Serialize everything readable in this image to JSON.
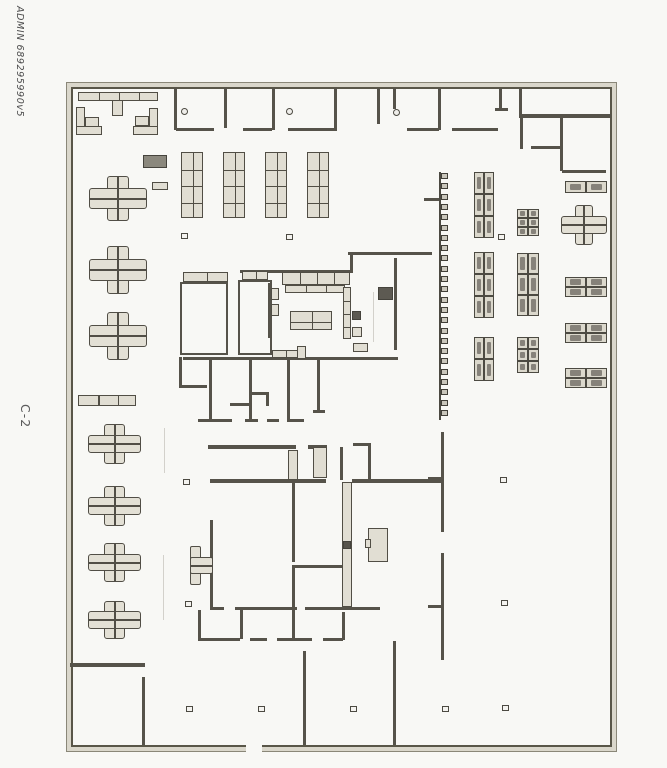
{
  "annotations": {
    "doc_id": "ADMIN 689295990v5",
    "sheet_label": "C-2"
  },
  "colors": {
    "paper": "#f8f8f5",
    "ink": "#56534a",
    "furniture_fill": "#e1ded3",
    "dark_fill": "#5d5a52",
    "gray_fill": "#8b887d"
  },
  "plan": {
    "frame": {
      "x": 66,
      "y": 82,
      "w": 551,
      "h": 670
    },
    "walls": [
      [
        174,
        88,
        3,
        42
      ],
      [
        224,
        88,
        3,
        40
      ],
      [
        272,
        88,
        3,
        42
      ],
      [
        334,
        88,
        3,
        43
      ],
      [
        377,
        88,
        3,
        36
      ],
      [
        393,
        88,
        3,
        21
      ],
      [
        438,
        88,
        3,
        42
      ],
      [
        499,
        88,
        3,
        21
      ],
      [
        176,
        128,
        38,
        3
      ],
      [
        243,
        128,
        29,
        3
      ],
      [
        288,
        128,
        48,
        3
      ],
      [
        407,
        128,
        32,
        3
      ],
      [
        452,
        128,
        46,
        3
      ],
      [
        495,
        108,
        13,
        3
      ],
      [
        519,
        88,
        3,
        28
      ],
      [
        519,
        114,
        92,
        4
      ],
      [
        520,
        118,
        3,
        31
      ],
      [
        531,
        146,
        31,
        3
      ],
      [
        560,
        117,
        3,
        54
      ],
      [
        562,
        170,
        44,
        3
      ],
      [
        240,
        270,
        112,
        3
      ],
      [
        348,
        252,
        84,
        3
      ],
      [
        350,
        252,
        3,
        21
      ],
      [
        394,
        258,
        3,
        92
      ],
      [
        268,
        283,
        3,
        55
      ],
      [
        180,
        282,
        2,
        73
      ],
      [
        226,
        282,
        2,
        73
      ],
      [
        180,
        282,
        48,
        2
      ],
      [
        180,
        353,
        48,
        2
      ],
      [
        238,
        280,
        2,
        75
      ],
      [
        238,
        280,
        34,
        2
      ],
      [
        238,
        353,
        34,
        2
      ],
      [
        270,
        280,
        2,
        75
      ],
      [
        183,
        357,
        215,
        3
      ],
      [
        179,
        357,
        3,
        31
      ],
      [
        179,
        385,
        28,
        3
      ],
      [
        209,
        360,
        3,
        62
      ],
      [
        249,
        360,
        3,
        62
      ],
      [
        287,
        360,
        3,
        62
      ],
      [
        317,
        360,
        3,
        53
      ],
      [
        313,
        410,
        12,
        3
      ],
      [
        230,
        403,
        22,
        3
      ],
      [
        252,
        392,
        17,
        3
      ],
      [
        266,
        392,
        3,
        14
      ],
      [
        198,
        419,
        34,
        3
      ],
      [
        245,
        419,
        13,
        3
      ],
      [
        267,
        419,
        12,
        3
      ],
      [
        290,
        419,
        14,
        3
      ],
      [
        424,
        198,
        17,
        3
      ],
      [
        208,
        445,
        88,
        4
      ],
      [
        308,
        445,
        19,
        4
      ],
      [
        340,
        447,
        3,
        33
      ],
      [
        353,
        443,
        17,
        3
      ],
      [
        368,
        443,
        3,
        38
      ],
      [
        210,
        479,
        116,
        4
      ],
      [
        352,
        479,
        90,
        4
      ],
      [
        210,
        520,
        3,
        88
      ],
      [
        292,
        482,
        3,
        80
      ],
      [
        292,
        565,
        50,
        3
      ],
      [
        292,
        568,
        3,
        40
      ],
      [
        441,
        432,
        3,
        100
      ],
      [
        441,
        553,
        3,
        107
      ],
      [
        428,
        477,
        14,
        3
      ],
      [
        428,
        605,
        14,
        3
      ],
      [
        210,
        607,
        14,
        3
      ],
      [
        235,
        607,
        62,
        3
      ],
      [
        305,
        607,
        75,
        3
      ],
      [
        198,
        610,
        3,
        29
      ],
      [
        240,
        610,
        3,
        29
      ],
      [
        292,
        610,
        3,
        30
      ],
      [
        342,
        612,
        3,
        28
      ],
      [
        198,
        638,
        42,
        3
      ],
      [
        250,
        638,
        17,
        3
      ],
      [
        277,
        638,
        35,
        3
      ],
      [
        323,
        638,
        20,
        3
      ],
      [
        70,
        663,
        75,
        4
      ],
      [
        142,
        677,
        3,
        68
      ],
      [
        303,
        651,
        3,
        94
      ],
      [
        393,
        641,
        3,
        104
      ]
    ],
    "light_blocks": [
      [
        112,
        97,
        11,
        19
      ],
      [
        76,
        107,
        9,
        27
      ],
      [
        76,
        126,
        26,
        9
      ],
      [
        85,
        117,
        14,
        10
      ],
      [
        149,
        108,
        9,
        27
      ],
      [
        133,
        126,
        25,
        9
      ],
      [
        135,
        116,
        14,
        10
      ],
      [
        288,
        450,
        10,
        30
      ],
      [
        313,
        447,
        14,
        31
      ],
      [
        342,
        482,
        10,
        125
      ],
      [
        368,
        528,
        20,
        34
      ],
      [
        365,
        539,
        6,
        9
      ],
      [
        352,
        327,
        10,
        10
      ],
      [
        353,
        343,
        15,
        9
      ],
      [
        297,
        346,
        9,
        13
      ],
      [
        271,
        288,
        8,
        12
      ],
      [
        271,
        304,
        8,
        12
      ],
      [
        152,
        182,
        16,
        8
      ]
    ],
    "dark_blocks": [
      [
        143,
        155,
        24,
        13,
        "#8b887d"
      ],
      [
        378,
        287,
        15,
        13,
        "#5d5a52"
      ],
      [
        352,
        311,
        9,
        9,
        "#5d5a52"
      ],
      [
        343,
        541,
        8,
        8,
        "#57544c"
      ]
    ],
    "grid_tables": [
      [
        78,
        92,
        80,
        9,
        4,
        1
      ],
      [
        181,
        152,
        22,
        66,
        2,
        4
      ],
      [
        223,
        152,
        22,
        66,
        2,
        4
      ],
      [
        265,
        152,
        22,
        66,
        2,
        4
      ],
      [
        307,
        152,
        22,
        66,
        2,
        4
      ],
      [
        282,
        272,
        68,
        13,
        4,
        1
      ],
      [
        285,
        285,
        60,
        8,
        3,
        1
      ],
      [
        290,
        311,
        42,
        19,
        2,
        2
      ],
      [
        343,
        287,
        8,
        52,
        1,
        4
      ],
      [
        272,
        350,
        26,
        8,
        2,
        1
      ],
      [
        183,
        272,
        45,
        10,
        2,
        1
      ],
      [
        242,
        271,
        26,
        9,
        2,
        1
      ],
      [
        78,
        395,
        58,
        11,
        3,
        1
      ]
    ],
    "desk_groups": [
      [
        474,
        172,
        2,
        3,
        10,
        22
      ],
      [
        474,
        252,
        2,
        3,
        10,
        22
      ],
      [
        474,
        337,
        2,
        2,
        10,
        22
      ],
      [
        517,
        209,
        2,
        3,
        11,
        9
      ],
      [
        517,
        253,
        2,
        3,
        11,
        21
      ],
      [
        517,
        337,
        2,
        3,
        11,
        12
      ],
      [
        565,
        181,
        2,
        1,
        21,
        12
      ],
      [
        565,
        277,
        2,
        2,
        21,
        10
      ],
      [
        565,
        323,
        2,
        2,
        21,
        10
      ],
      [
        565,
        368,
        2,
        2,
        21,
        10
      ]
    ],
    "crosses": [
      [
        89,
        176,
        58,
        45
      ],
      [
        89,
        246,
        58,
        48
      ],
      [
        89,
        312,
        58,
        48
      ],
      [
        88,
        424,
        53,
        40
      ],
      [
        88,
        486,
        53,
        40
      ],
      [
        88,
        543,
        53,
        39
      ],
      [
        88,
        601,
        53,
        38
      ],
      [
        561,
        205,
        46,
        40
      ]
    ],
    "half_cross": [
      190,
      543,
      23,
      45
    ],
    "lockers": {
      "x": 439,
      "y": 172,
      "h": 248,
      "cells": 24,
      "step": 10.3
    },
    "markers": [
      [
        181,
        233
      ],
      [
        286,
        234
      ],
      [
        498,
        234
      ],
      [
        183,
        479
      ],
      [
        185,
        601
      ],
      [
        186,
        706
      ],
      [
        500,
        477
      ],
      [
        501,
        600
      ],
      [
        502,
        705
      ],
      [
        258,
        706
      ],
      [
        350,
        706
      ],
      [
        442,
        706
      ]
    ],
    "door_dots": [
      [
        181,
        108
      ],
      [
        286,
        108
      ],
      [
        393,
        109
      ]
    ],
    "faint_lines": [
      [
        164,
        428,
        1,
        45
      ],
      [
        163,
        555,
        1,
        65
      ],
      [
        373,
        292,
        1,
        50
      ]
    ],
    "wall_gaps": [
      [
        246,
        742,
        16,
        12
      ]
    ]
  }
}
